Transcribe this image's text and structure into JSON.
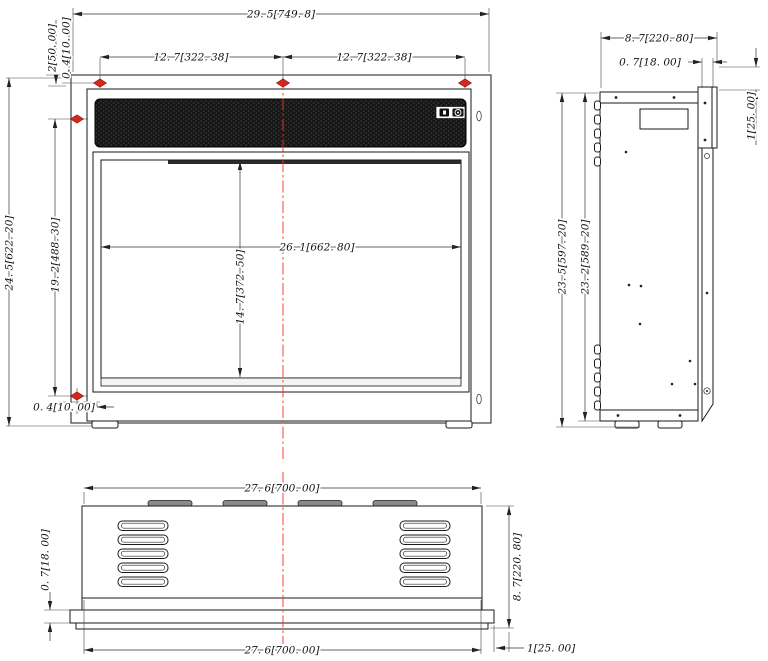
{
  "views": {
    "front": {
      "dims": {
        "overall_width": "29. 5[749. 8]",
        "hole_spacing_left": "12. 7[322. 38]",
        "hole_spacing_right": "12. 7[322. 38]",
        "top_inset": "2[50. 00]",
        "top_hole_offset": "0. 4[10. 00]",
        "overall_height": "24. 5[622. 20]",
        "side_hole_spacing": "19. 2[488. 30]",
        "bottom_hole_offset": "0. 4[10. 00]",
        "opening_width": "26. 1[662. 80]",
        "opening_height": "14. 7[372. 50]"
      }
    },
    "side": {
      "dims": {
        "overall_depth": "8. 7[220. 80]",
        "flange_depth": "0. 7[18. 00]",
        "bracket_offset": "1[25. 00]",
        "overall_height": "23. 5[597. 20]",
        "body_height": "23. 2[589. 20]"
      }
    },
    "bottom": {
      "dims": {
        "width_top": "27. 6[700. 00]",
        "width_bottom": "27. 6[700. 00]",
        "overall_depth": "8. 7[220. 80]",
        "flange_thickness": "0. 7[18. 00]",
        "flange_offset": "1[25. 00]"
      }
    }
  },
  "icons": {
    "panel_left": "display-button-icon",
    "panel_right": "power-button-icon",
    "hole": "mounting-hole-marker",
    "centerline": "centerline"
  },
  "colors": {
    "marker_red": "#d2281e",
    "centerline_red": "#f03322",
    "line": "#1a1a1a",
    "grille_dark": "#161616"
  }
}
